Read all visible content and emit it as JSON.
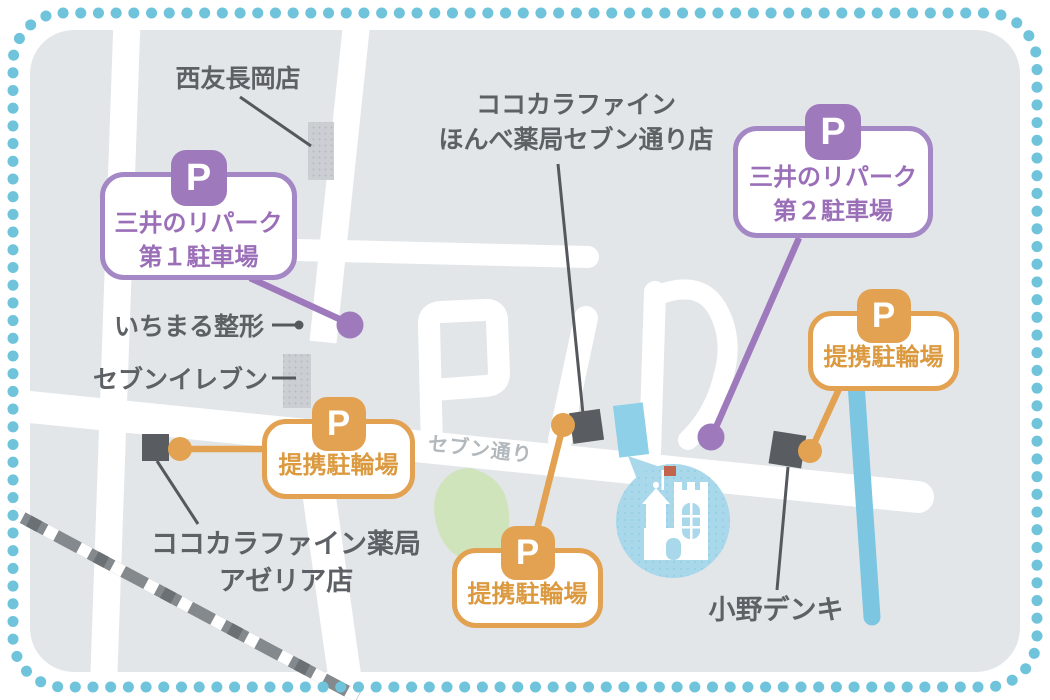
{
  "labels": {
    "seiyu": "西友長岡店",
    "cocokara_honbe_1": "ココカラファイン",
    "cocokara_honbe_2": "ほんべ薬局セブン通り店",
    "ichimaru": "いちまる整形",
    "seven_eleven": "セブンイレブン",
    "cocokara_azeria_1": "ココカラファイン薬局",
    "cocokara_azeria_2": "アゼリア店",
    "ono_denki": "小野デンキ",
    "street": "セブン通り"
  },
  "callouts": {
    "parking1": {
      "badge": "P",
      "line1": "三井のリパーク",
      "line2": "第１駐車場"
    },
    "parking2": {
      "badge": "P",
      "line1": "三井のリパーク",
      "line2": "第２駐車場"
    },
    "bike_left": {
      "badge": "P",
      "label": "提携駐輪場"
    },
    "bike_center": {
      "badge": "P",
      "label": "提携駐輪場"
    },
    "bike_right": {
      "badge": "P",
      "label": "提携駐輪場"
    }
  },
  "colors": {
    "purple_accent": "#9E7ABD",
    "purple_text": "#9B6FB8",
    "orange_accent": "#E2A251",
    "orange_text": "#DC9A40",
    "map_background": "#E3E6E9",
    "road": "#FFFFFF",
    "border_dots": "#6FC4DC",
    "river_blue": "#7CC6E2",
    "landmark_circle_blue": "#A9D8EB",
    "marker_dark": "#595D61",
    "label_text": "#5D6165",
    "park_green": "#D0E4BC"
  }
}
